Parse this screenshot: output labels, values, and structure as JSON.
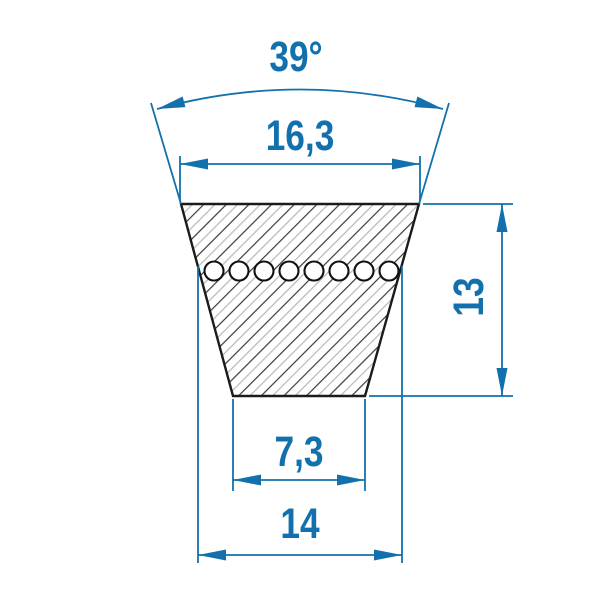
{
  "drawing": {
    "kind": "v-belt-cross-section",
    "labels": {
      "angle": "39°",
      "top_width": "16,3",
      "height": "13",
      "bottom_width": "7,3",
      "datum_width": "14"
    },
    "cord_count": 8,
    "colors": {
      "dimension_blue": "#1271ad",
      "outline_black": "#1b1b1b",
      "hatch_dark": "#3a3a3a",
      "hatch_light": "#b8b8b8",
      "fill_white": "#ffffff"
    }
  }
}
